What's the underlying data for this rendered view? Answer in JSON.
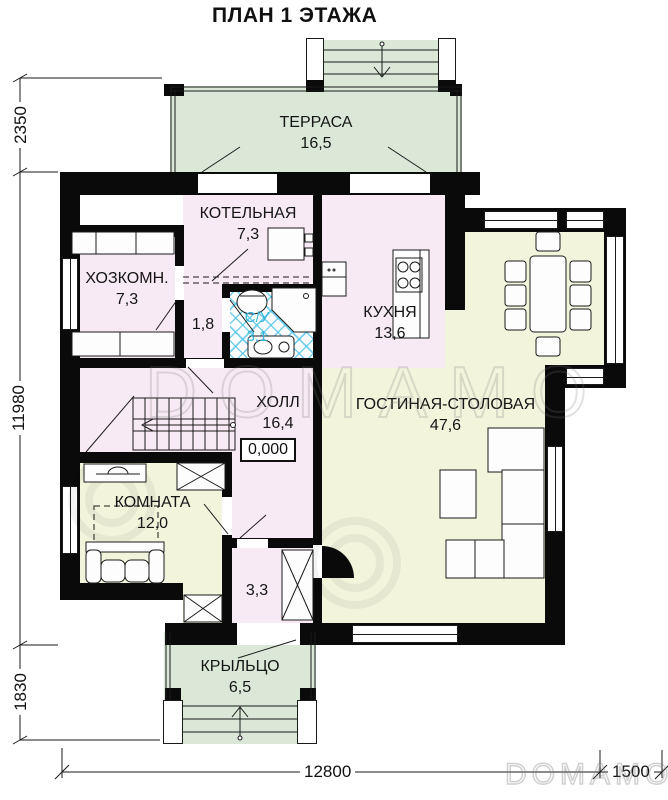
{
  "title": "ПЛАН 1 ЭТАЖА",
  "rooms": [
    {
      "id": "terrace",
      "name": "ТЕРРАСА",
      "area": "16,5"
    },
    {
      "id": "boiler",
      "name": "КОТЕЛЬНАЯ",
      "area": "7,3"
    },
    {
      "id": "utility",
      "name": "ХОЗКОМН.",
      "area": "7,3"
    },
    {
      "id": "corridor",
      "name": "",
      "area": "1,8"
    },
    {
      "id": "bathroom",
      "name": "С/У",
      "area": "3,1"
    },
    {
      "id": "kitchen",
      "name": "КУХНЯ",
      "area": "13,6"
    },
    {
      "id": "living",
      "name": "ГОСТИНАЯ-СТОЛОВАЯ",
      "area": "47,6"
    },
    {
      "id": "hall",
      "name": "ХОЛЛ",
      "area": "16,4"
    },
    {
      "id": "room",
      "name": "КОМНАТА",
      "area": "12,0"
    },
    {
      "id": "tambour",
      "name": "",
      "area": "3,3"
    },
    {
      "id": "porch",
      "name": "КРЫЛЬЦО",
      "area": "6,5"
    }
  ],
  "elevation_mark": "0,000",
  "dimensions": {
    "left": [
      "2350",
      "11980",
      "1830"
    ],
    "bottom": [
      "12800",
      "1500"
    ]
  },
  "watermark": {
    "text": "DOMAMO",
    "text_small": "DOMAMO"
  },
  "colors": {
    "terrace_green": "#dbe8d8",
    "room_pink": "#f8eaf4",
    "room_yellow": "#f2f4dc",
    "tile_blue": "#35b4dd",
    "wall_black": "#0a0a0a"
  }
}
